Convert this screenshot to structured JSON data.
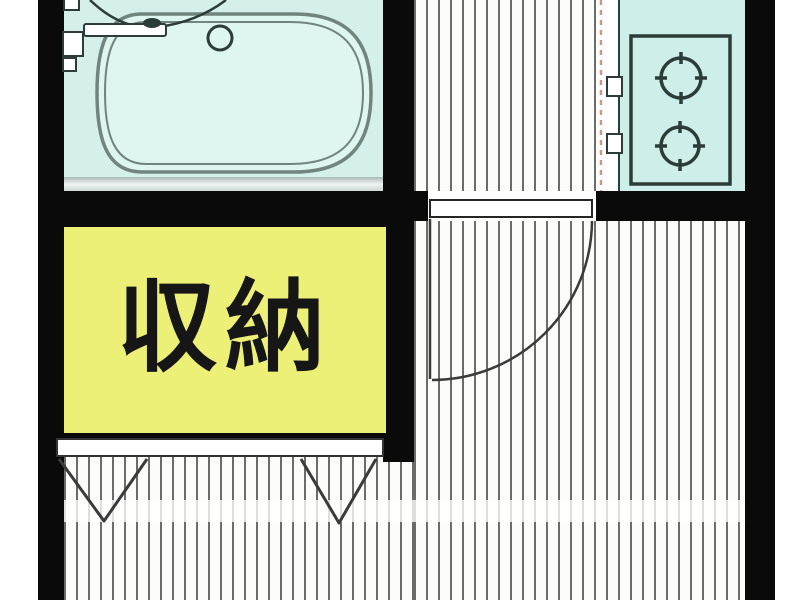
{
  "floorplan": {
    "labels": {
      "closet": "収納"
    },
    "colors": {
      "wall": "#0a0a0a",
      "bath_bg": "#d5f0ea",
      "tub_fill": "#def5f0",
      "tub_line": "#71847f",
      "counter_bg": "#cdeee9",
      "fixture": "#2c3c38",
      "closet_bg": "#edf076",
      "closet_ink": "#161616",
      "floor_bg": "#fcfcfb",
      "stripe": "#6b6b6b",
      "dash": "#c59a8e",
      "door": "#3b3b3b"
    },
    "rooms": [
      "bathroom",
      "kitchen",
      "closet",
      "main-room"
    ],
    "fixtures": [
      "bathtub",
      "bath-faucet",
      "washbasin-arc",
      "tub-drain",
      "two-burner-cooktop",
      "stove-knobs",
      "hinged-door-swing",
      "closet-folding-door-marks"
    ]
  }
}
